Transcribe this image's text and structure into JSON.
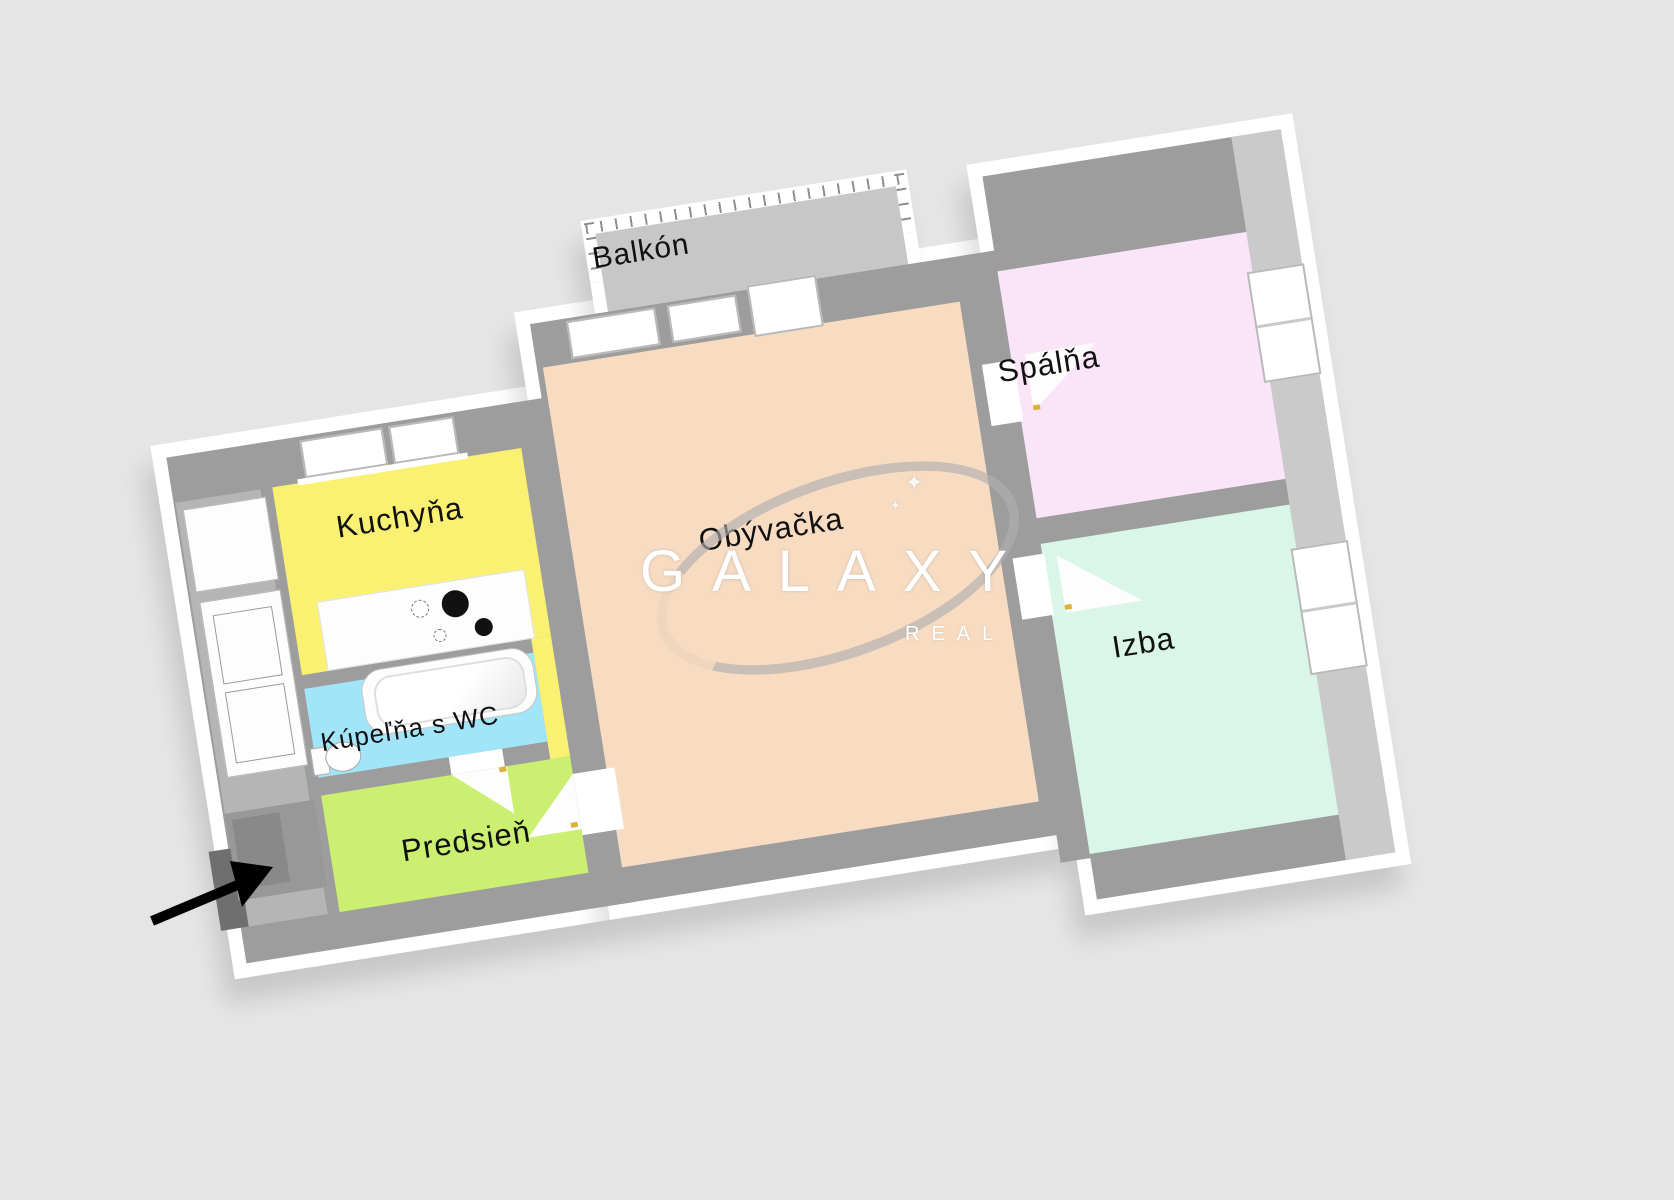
{
  "scene": {
    "type": "floor-plan",
    "background_color": "#e5e5e5",
    "outer_wall_color": "#ffffff",
    "inner_wall_color": "#9d9d9d",
    "wall_side_color": "#cacaca",
    "rotation_deg": -9
  },
  "rooms": [
    {
      "id": "balkon",
      "label": "Balkón",
      "floor_color": "#c7c7c7"
    },
    {
      "id": "kuchyna",
      "label": "Kuchyňa",
      "floor_color": "#faf173"
    },
    {
      "id": "obyvacka",
      "label": "Obývačka",
      "floor_color": "#f8dcc2"
    },
    {
      "id": "spalna",
      "label": "Spálňa",
      "floor_color": "#fae4f8"
    },
    {
      "id": "izba",
      "label": "Izba",
      "floor_color": "#d9f6e9"
    },
    {
      "id": "kupelna",
      "label": "Kúpeľňa s WC",
      "floor_color": "#a2e5f9"
    },
    {
      "id": "predsien",
      "label": "Predsieň",
      "floor_color": "#cbef70"
    }
  ],
  "watermark": {
    "brand": "GALAXY",
    "sub": "REAL",
    "text_color": "#ffffff",
    "swoosh_color": "#b0b0b0",
    "sparkles": [
      "✦",
      "✦"
    ]
  },
  "entrance": {
    "arrow_color": "#000000",
    "door_color": "#6f6f6f"
  }
}
